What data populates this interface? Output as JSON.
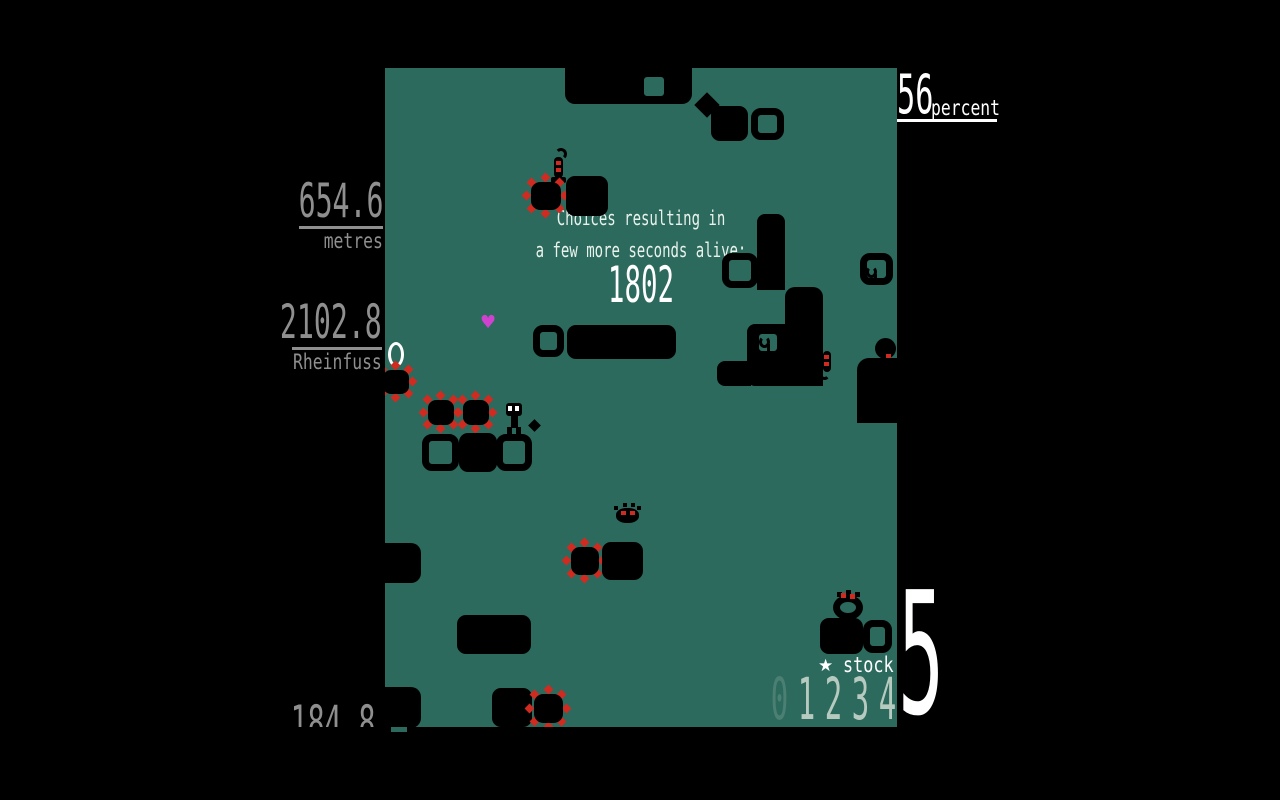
{
  "colors": {
    "teal": "#2d6a5e",
    "red": "#cf2b20",
    "magenta": "#cf42cf",
    "hud_dim": "#8f8f8f",
    "white": "#ffffff",
    "ghost": "#b6cabf"
  },
  "hud": {
    "percent": {
      "value": "56",
      "label": "percent"
    },
    "left_metrics": [
      {
        "value": "654.6",
        "label": "metres"
      },
      {
        "value": "2102.8",
        "label": "Rheinfuss"
      },
      {
        "value": "184.8",
        "label": ""
      }
    ],
    "stock": {
      "star": "★",
      "label": "stock",
      "ghost": [
        "0",
        "1",
        "2",
        "3",
        "4"
      ],
      "current": "5"
    }
  },
  "message": {
    "line1": "Choices resulting in",
    "line2": "a few more seconds alive:",
    "value": "1802"
  },
  "playfield": {
    "objects": [
      {
        "type": "band",
        "name": "ceiling-block",
        "x": 180,
        "y": 0,
        "w": 127,
        "h": 36,
        "r": "0 0 10px 10px"
      },
      {
        "type": "hollow",
        "name": "window-block",
        "x": 252,
        "y": 2,
        "w": 34,
        "h": 33
      },
      {
        "type": "diamond",
        "name": "diamond-block",
        "x": 313,
        "y": 28,
        "w": 18,
        "h": 18
      },
      {
        "type": "solid",
        "name": "solid-block",
        "x": 326,
        "y": 38,
        "w": 37,
        "h": 35
      },
      {
        "type": "hollow",
        "name": "window-block",
        "x": 366,
        "y": 40,
        "w": 33,
        "h": 32
      },
      {
        "type": "worm",
        "name": "worm-enemy",
        "x": 164,
        "y": 80,
        "w": 20,
        "h": 36
      },
      {
        "type": "mine",
        "name": "spike-mine",
        "x": 142,
        "y": 110,
        "w": 38,
        "h": 36
      },
      {
        "type": "solid",
        "name": "solid-block",
        "x": 181,
        "y": 108,
        "w": 42,
        "h": 40
      },
      {
        "type": "hollow",
        "name": "window-block",
        "x": 148,
        "y": 257,
        "w": 31,
        "h": 32
      },
      {
        "type": "solid",
        "name": "solid-block",
        "x": 182,
        "y": 257,
        "w": 109,
        "h": 34
      },
      {
        "type": "heart",
        "name": "heart-pickup",
        "glyph": "♥",
        "x": 95,
        "y": 246
      },
      {
        "type": "ring",
        "name": "ring-object",
        "x": 3,
        "y": 274,
        "w": 16,
        "h": 25
      },
      {
        "type": "mine",
        "name": "spike-mine",
        "x": -6,
        "y": 298,
        "w": 34,
        "h": 32
      },
      {
        "type": "mine",
        "name": "spike-mine",
        "x": 39,
        "y": 328,
        "w": 34,
        "h": 33
      },
      {
        "type": "mine",
        "name": "spike-mine",
        "x": 74,
        "y": 328,
        "w": 34,
        "h": 33
      },
      {
        "type": "player",
        "name": "player-character",
        "x": 121,
        "y": 335,
        "w": 17,
        "h": 31
      },
      {
        "type": "dot",
        "name": "debris-dot",
        "x": 145,
        "y": 353,
        "w": 9,
        "h": 9
      },
      {
        "type": "hollow",
        "name": "window-block",
        "x": 37,
        "y": 366,
        "w": 37,
        "h": 37
      },
      {
        "type": "solid",
        "name": "solid-block",
        "x": 74,
        "y": 365,
        "w": 38,
        "h": 39
      },
      {
        "type": "hollow",
        "name": "window-block",
        "x": 111,
        "y": 366,
        "w": 36,
        "h": 37
      },
      {
        "type": "band",
        "name": "structure-column",
        "x": 372,
        "y": 146,
        "w": 28,
        "h": 76,
        "r": "8px 8px 0 0"
      },
      {
        "type": "hollow",
        "name": "window-block",
        "x": 337,
        "y": 185,
        "w": 36,
        "h": 35
      },
      {
        "type": "band",
        "name": "structure-step",
        "x": 400,
        "y": 219,
        "w": 38,
        "h": 99,
        "r": "10px 10px 0 0"
      },
      {
        "type": "band",
        "name": "structure-step",
        "x": 362,
        "y": 256,
        "w": 40,
        "h": 62,
        "r": "8px 0 0 8px"
      },
      {
        "type": "hollow",
        "name": "window-block",
        "x": 367,
        "y": 259,
        "w": 32,
        "h": 31
      },
      {
        "type": "band",
        "name": "structure-step",
        "x": 332,
        "y": 293,
        "w": 34,
        "h": 25,
        "r": "8px 0 0 8px"
      },
      {
        "type": "squiggle",
        "name": "small-creature",
        "x": 374,
        "y": 266,
        "w": 13,
        "h": 16
      },
      {
        "type": "seahorse",
        "name": "seahorse-enemy",
        "x": 433,
        "y": 282,
        "w": 16,
        "h": 30
      },
      {
        "type": "hollow",
        "name": "window-block",
        "x": 475,
        "y": 185,
        "w": 33,
        "h": 32
      },
      {
        "type": "squiggle",
        "name": "small-creature",
        "x": 481,
        "y": 196,
        "w": 13,
        "h": 16
      },
      {
        "type": "blob",
        "name": "creature-head",
        "x": 490,
        "y": 270,
        "w": 21,
        "h": 21
      },
      {
        "type": "reddot",
        "name": "creature-eye",
        "x": 501,
        "y": 286,
        "w": 5,
        "h": 5
      },
      {
        "type": "band",
        "name": "right-edge-block",
        "x": 472,
        "y": 290,
        "w": 40,
        "h": 65,
        "r": "12px 0 0 0"
      },
      {
        "type": "bug",
        "name": "bug-enemy",
        "x": 230,
        "y": 435,
        "w": 26,
        "h": 22
      },
      {
        "type": "mine",
        "name": "spike-mine",
        "x": 182,
        "y": 475,
        "w": 36,
        "h": 36
      },
      {
        "type": "solid",
        "name": "solid-block",
        "x": 217,
        "y": 474,
        "w": 41,
        "h": 38
      },
      {
        "type": "notch",
        "name": "edge-notch",
        "x": 0,
        "y": 475,
        "w": 36,
        "h": 40,
        "r": "0 10px 10px 0"
      },
      {
        "type": "notch",
        "name": "edge-notch",
        "x": 0,
        "y": 619,
        "w": 36,
        "h": 41,
        "r": "0 10px 10px 0"
      },
      {
        "type": "solid",
        "name": "solid-block",
        "x": 72,
        "y": 547,
        "w": 74,
        "h": 39
      },
      {
        "type": "solid",
        "name": "solid-block",
        "x": 107,
        "y": 620,
        "w": 40,
        "h": 39
      },
      {
        "type": "mine",
        "name": "spike-mine",
        "x": 145,
        "y": 622,
        "w": 37,
        "h": 37
      },
      {
        "type": "wreath",
        "name": "wreath-creature",
        "x": 448,
        "y": 524,
        "w": 31,
        "h": 29
      },
      {
        "type": "solid",
        "name": "solid-block",
        "x": 435,
        "y": 550,
        "w": 43,
        "h": 36
      },
      {
        "type": "hollow",
        "name": "window-block",
        "x": 478,
        "y": 552,
        "w": 29,
        "h": 33
      }
    ]
  }
}
